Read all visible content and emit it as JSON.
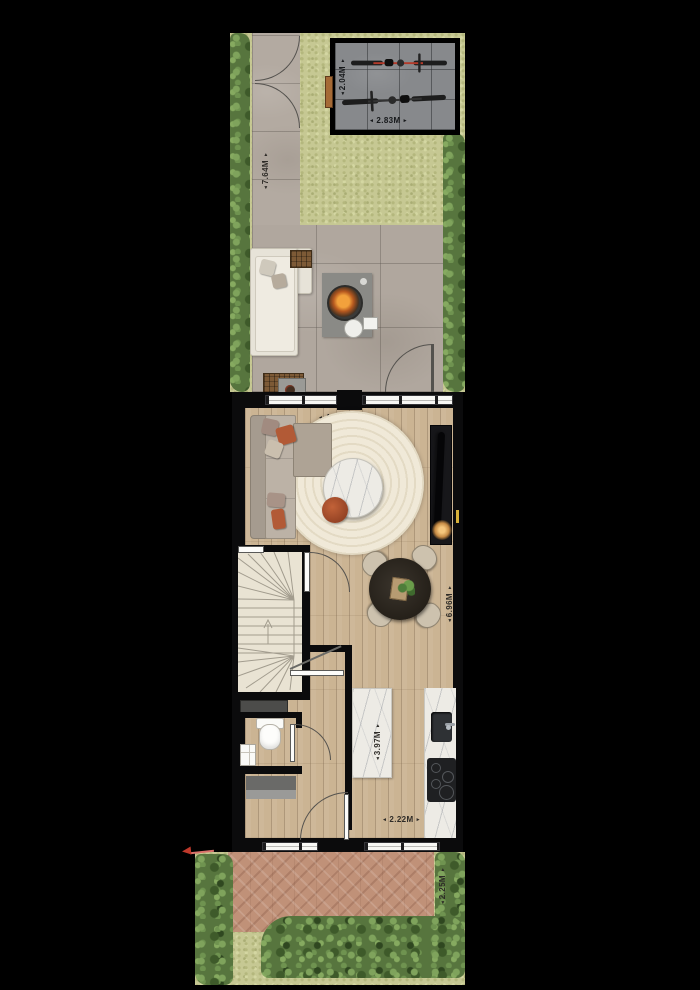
{
  "icons": {
    "arrow_up": "▲",
    "arrow_down": "▼",
    "arrow_left": "◄",
    "arrow_right": "►"
  },
  "dimensions": {
    "shed_depth": "2.04M",
    "shed_width": "2.83M",
    "back_garden_length": "7.64M",
    "living_width": "4.50M",
    "living_depth": "2.82M",
    "open_plan_depth": "6.96M",
    "kitchen_depth": "3.97M",
    "kitchen_window_width": "2.22M",
    "front_garden_depth": "2.25M"
  },
  "colors": {
    "background": "#000000",
    "wall": "#0b0b0c",
    "grass": "#c6c893",
    "hedge": "#57753e",
    "paver": "#b3aaa1",
    "shed_floor": "#87898c",
    "wood": "#cbb493",
    "marble": "#edebe5",
    "brick": "#c09178",
    "rust": "#b0522e",
    "dim_text": "#2e2b27"
  }
}
